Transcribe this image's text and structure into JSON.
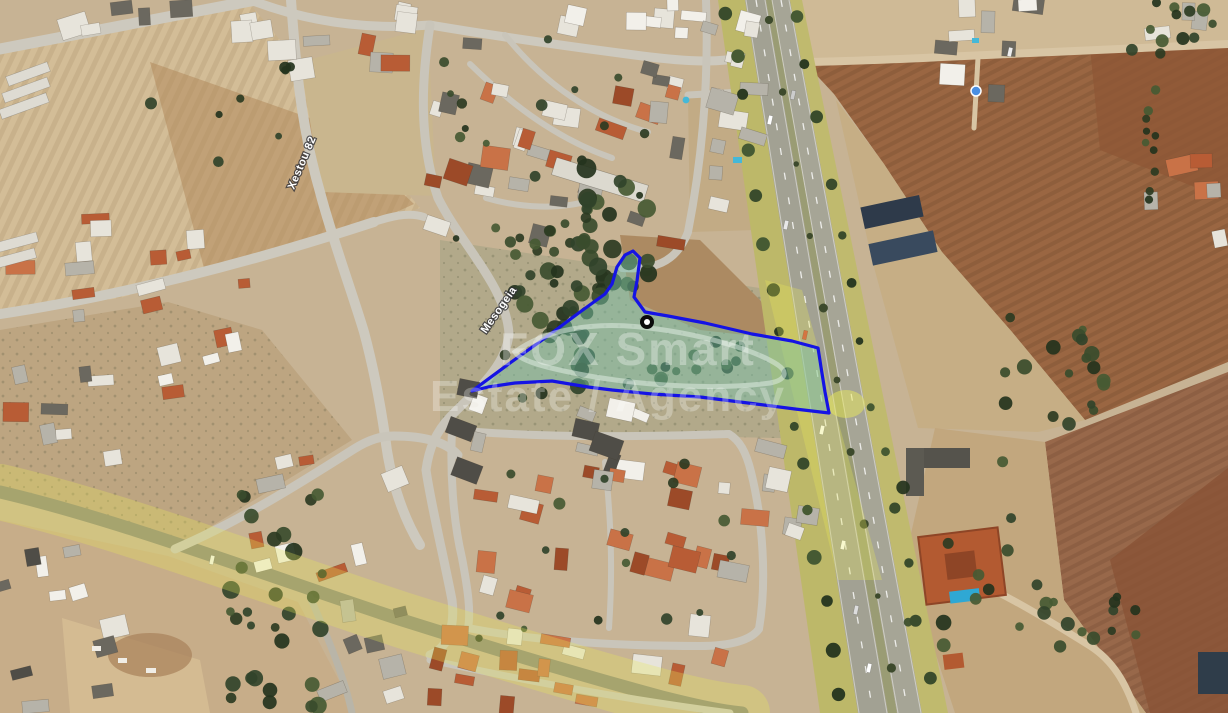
{
  "map": {
    "watermark": {
      "line1": "FOX Smart",
      "line2": "Estate / Agency",
      "color": "#ffffff"
    },
    "street_labels": [
      {
        "id": "mesogeia",
        "text": "Mesogeia"
      },
      {
        "id": "xestou",
        "text": "Xestou 82"
      }
    ],
    "parcel": {
      "outline_color": "#1513e4",
      "fill_color": "#6fc3ae",
      "fill_opacity": 0.42,
      "points": [
        [
          472,
          391
        ],
        [
          510,
          363
        ],
        [
          545,
          338
        ],
        [
          580,
          312
        ],
        [
          605,
          294
        ],
        [
          612,
          284
        ],
        [
          617,
          267
        ],
        [
          625,
          255
        ],
        [
          633,
          251
        ],
        [
          640,
          258
        ],
        [
          637,
          281
        ],
        [
          634,
          297
        ],
        [
          645,
          312
        ],
        [
          668,
          316
        ],
        [
          705,
          323
        ],
        [
          752,
          334
        ],
        [
          792,
          341
        ],
        [
          818,
          348
        ],
        [
          821,
          367
        ],
        [
          825,
          392
        ],
        [
          829,
          413
        ],
        [
          795,
          409
        ],
        [
          748,
          403
        ],
        [
          700,
          397
        ],
        [
          652,
          394
        ],
        [
          612,
          390
        ],
        [
          588,
          387
        ],
        [
          552,
          381
        ],
        [
          515,
          383
        ],
        [
          488,
          387
        ]
      ],
      "marker": {
        "x": 647,
        "y": 322
      }
    },
    "poi_dot": {
      "x": 976,
      "y": 91,
      "color": "#4a8fe2"
    },
    "overlay": {
      "highlight_color": "#e9e95a"
    }
  }
}
